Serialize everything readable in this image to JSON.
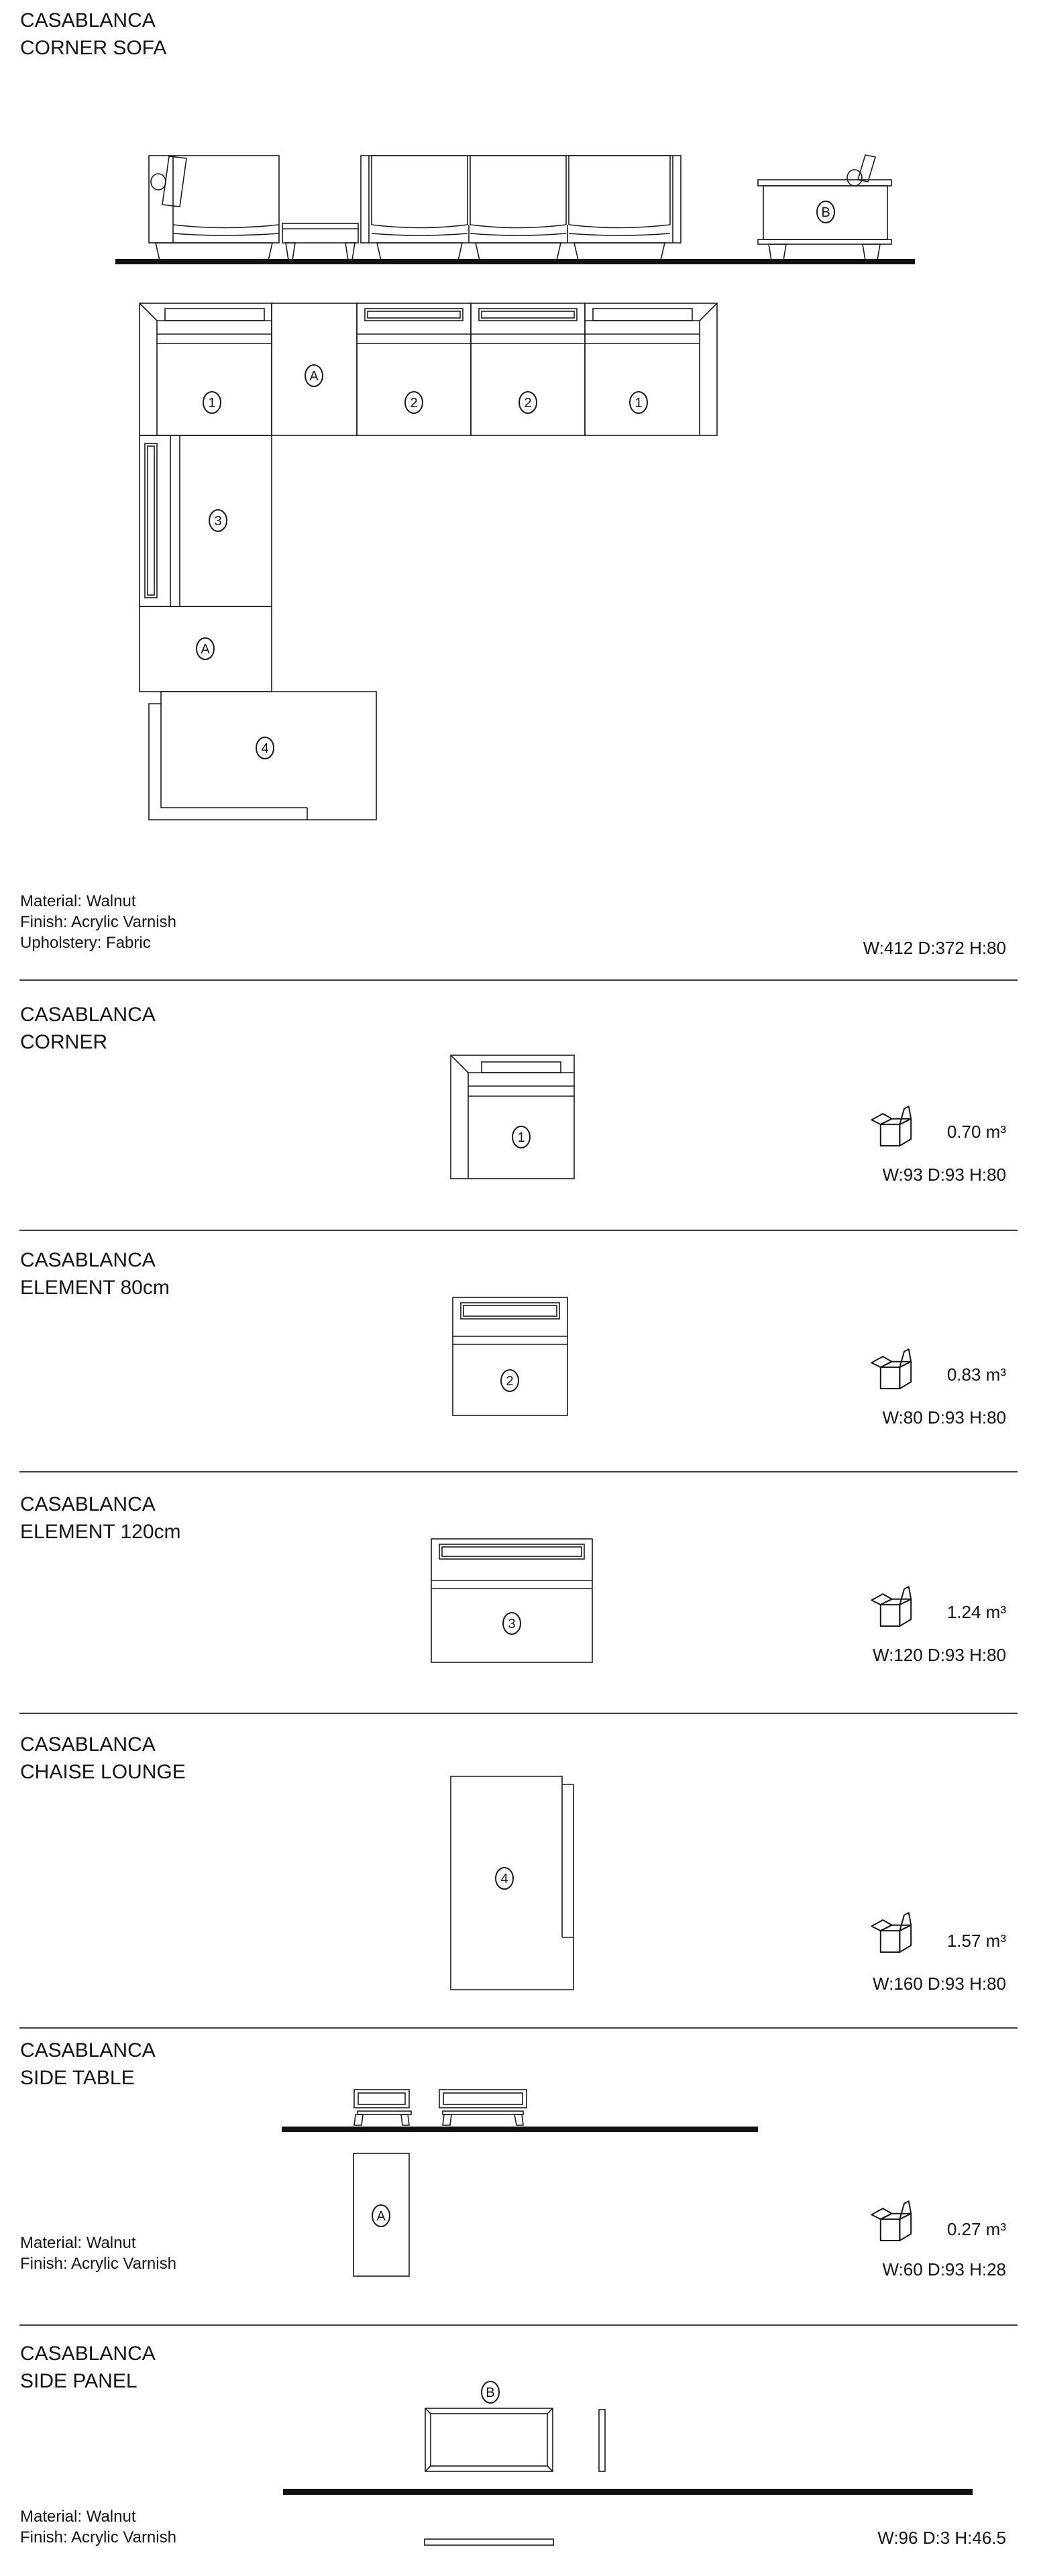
{
  "header": {
    "title_line1": "CASABLANCA",
    "title_line2": "CORNER SOFA"
  },
  "overview": {
    "materials": [
      "Material: Walnut",
      "Finish: Acrylic Varnish",
      "Upholstery: Fabric"
    ],
    "dims": "W:412 D:372 H:80"
  },
  "markers": {
    "corner": "1",
    "el80": "2",
    "el120": "3",
    "chaise": "4",
    "table": "A",
    "panel": "B"
  },
  "sections": [
    {
      "id": "corner",
      "title1": "CASABLANCA",
      "title2": "CORNER",
      "volume": "0.70 m³",
      "dims": "W:93 D:93 H:80"
    },
    {
      "id": "element80",
      "title1": "CASABLANCA",
      "title2": "ELEMENT 80cm",
      "volume": "0.83 m³",
      "dims": "W:80 D:93 H:80"
    },
    {
      "id": "element120",
      "title1": "CASABLANCA",
      "title2": "ELEMENT 120cm",
      "volume": "1.24 m³",
      "dims": "W:120 D:93 H:80"
    },
    {
      "id": "chaise",
      "title1": "CASABLANCA",
      "title2": "CHAISE LOUNGE",
      "volume": "1.57 m³",
      "dims": "W:160 D:93 H:80"
    },
    {
      "id": "side_table",
      "title1": "CASABLANCA",
      "title2": "SIDE TABLE",
      "materials": [
        "Material: Walnut",
        "Finish: Acrylic Varnish"
      ],
      "volume": "0.27 m³",
      "dims": "W:60 D:93 H:28"
    },
    {
      "id": "side_panel",
      "title1": "CASABLANCA",
      "title2": "SIDE PANEL",
      "materials": [
        "Material: Walnut",
        "Finish: Acrylic Varnish"
      ],
      "dims": "W:96 D:3 H:46.5"
    }
  ]
}
